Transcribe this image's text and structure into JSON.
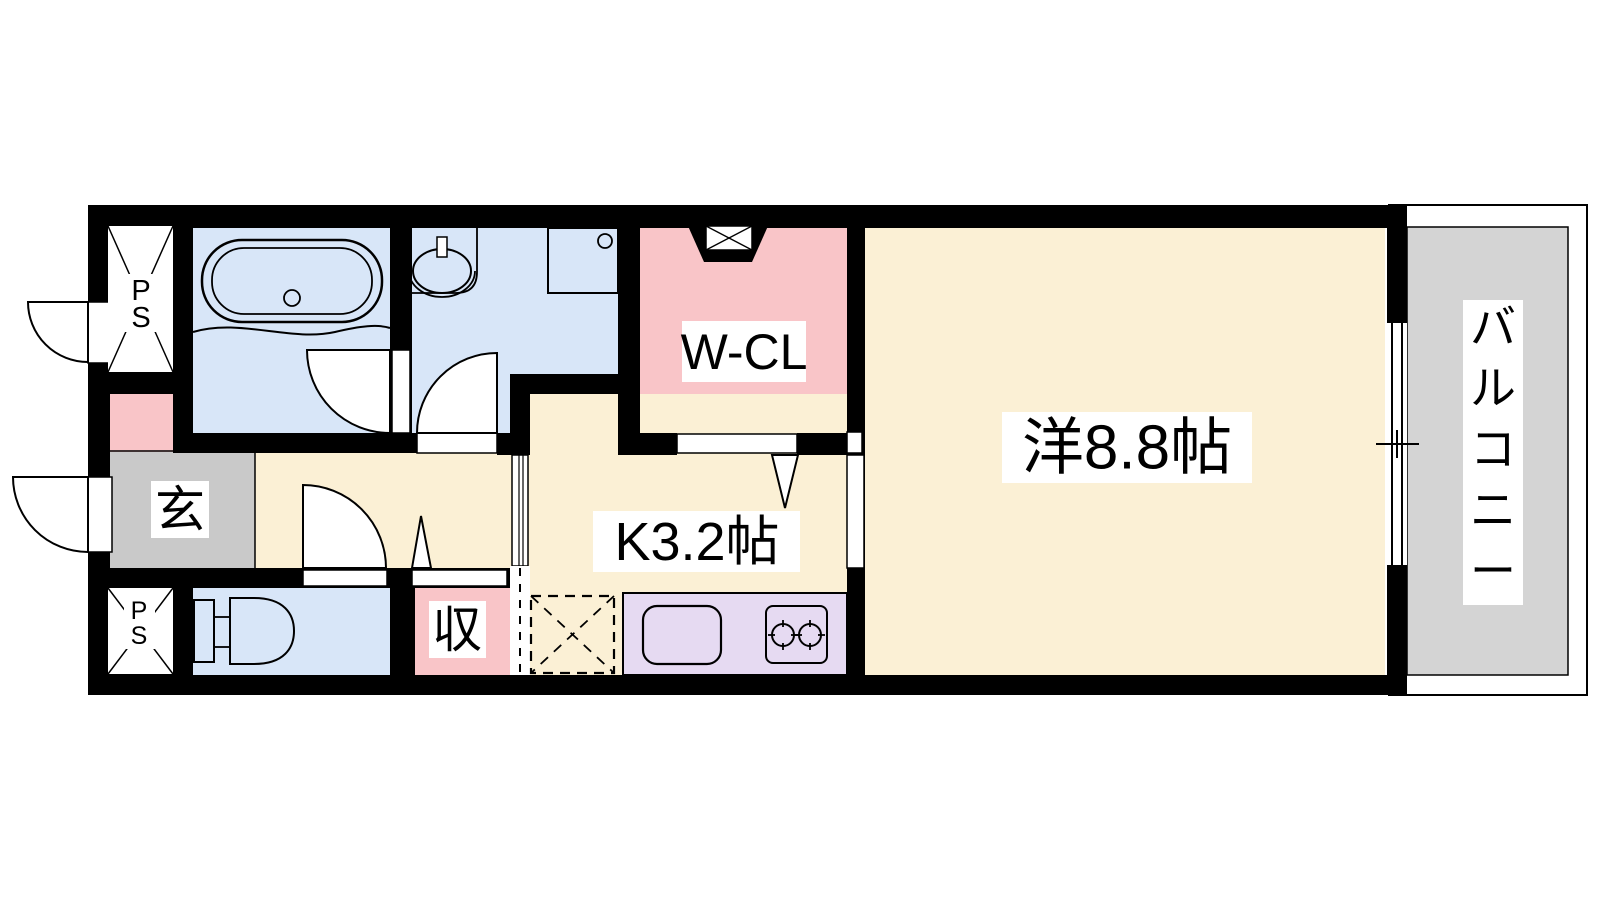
{
  "floorplan": {
    "colors": {
      "wall": "#000000",
      "wet_area": "#D8E6F8",
      "living_area": "#FBF0D5",
      "closet_pink": "#F9C5C8",
      "entrance_gray": "#C9C9C9",
      "balcony_gray": "#D4D4D4",
      "counter_purple": "#E6DAF2",
      "opening_white": "#FFFFFF"
    },
    "labels": {
      "western_room": "洋8.8帖",
      "kitchen": "K3.2帖",
      "walk_in_closet": "W-CL",
      "entrance": "玄",
      "storage": "収",
      "balcony": "バルコニー",
      "balcony_chars": [
        "バ",
        "ル",
        "コ",
        "ニ",
        "ー"
      ],
      "pipe_space_line1": "P",
      "pipe_space_line2": "S"
    }
  }
}
